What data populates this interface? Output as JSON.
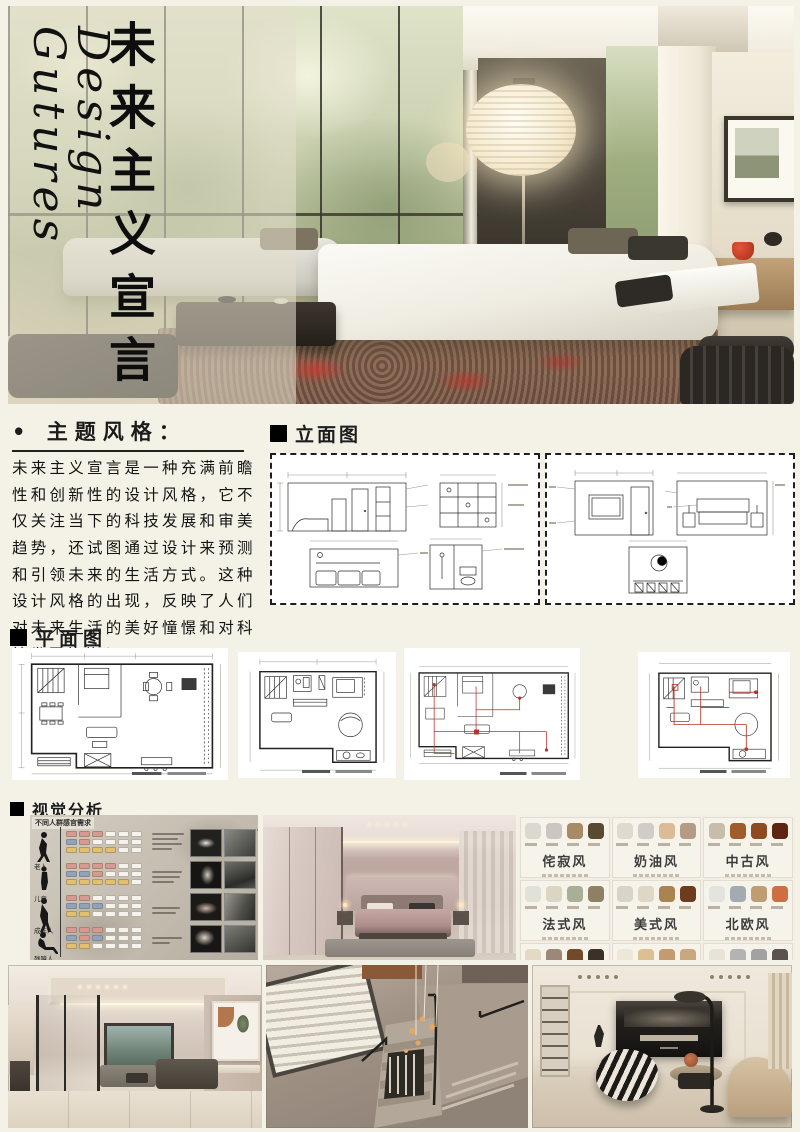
{
  "hero": {
    "title_en": "Design Gutures",
    "title_cn": "未来主义宣言"
  },
  "theme": {
    "bullet": "•",
    "heading": "主题风格：",
    "body": "未来主义宣言是一种充满前瞻性和创新性的设计风格，它不仅关注当下的科技发展和审美趋势，还试图通过设计来预测和引领未来的生活方式。这种设计风格的出现，反映了人们对未来生活的美好憧憬和对科技发展的信心。"
  },
  "sections": {
    "elevation": "立面图",
    "plan": "平面图",
    "visual": "视觉分析"
  },
  "moodboard": {
    "title": "不同人群感官需求",
    "groups": [
      "老人",
      "儿童",
      "成年人",
      "残障人"
    ]
  },
  "palette": {
    "styles": [
      {
        "name": "侘寂风",
        "colors": [
          "#DBD8D0",
          "#CCC6C2",
          "#A98A66",
          "#594A31"
        ]
      },
      {
        "name": "奶油风",
        "colors": [
          "#E0DACE",
          "#D1CCC8",
          "#DCBB97",
          "#B49B83"
        ]
      },
      {
        "name": "中古风",
        "colors": [
          "#C8BDAA",
          "#A15C2B",
          "#8E4B21",
          "#5F2511"
        ]
      },
      {
        "name": "法式风",
        "colors": [
          "#E2E1D7",
          "#DCD5C1",
          "#A9AF97",
          "#8F7F63"
        ]
      },
      {
        "name": "美式风",
        "colors": [
          "#D6D5C7",
          "#DDD7C3",
          "#AB8350",
          "#6D3C1E"
        ]
      },
      {
        "name": "北欧风",
        "colors": [
          "#E4E4DE",
          "#A3ABB1",
          "#BF9D72",
          "#CC6F43"
        ]
      },
      {
        "name": "新中式",
        "colors": [
          "#E3D9C4",
          "#9B8878",
          "#74492A",
          "#3B3128"
        ]
      },
      {
        "name": "原木风",
        "colors": [
          "#EEE6D6",
          "#DCC094",
          "#C49B6E",
          "#C9A87D"
        ]
      },
      {
        "name": "轻奢风",
        "colors": [
          "#E8E3D8",
          "#B3B3B3",
          "#A2A2A2",
          "#5C534E"
        ]
      }
    ]
  },
  "colors": {
    "plan_line_red": "#B5352B",
    "drawing_line": "#2A2A2A",
    "accent_red_bowl": "#B2301B"
  }
}
